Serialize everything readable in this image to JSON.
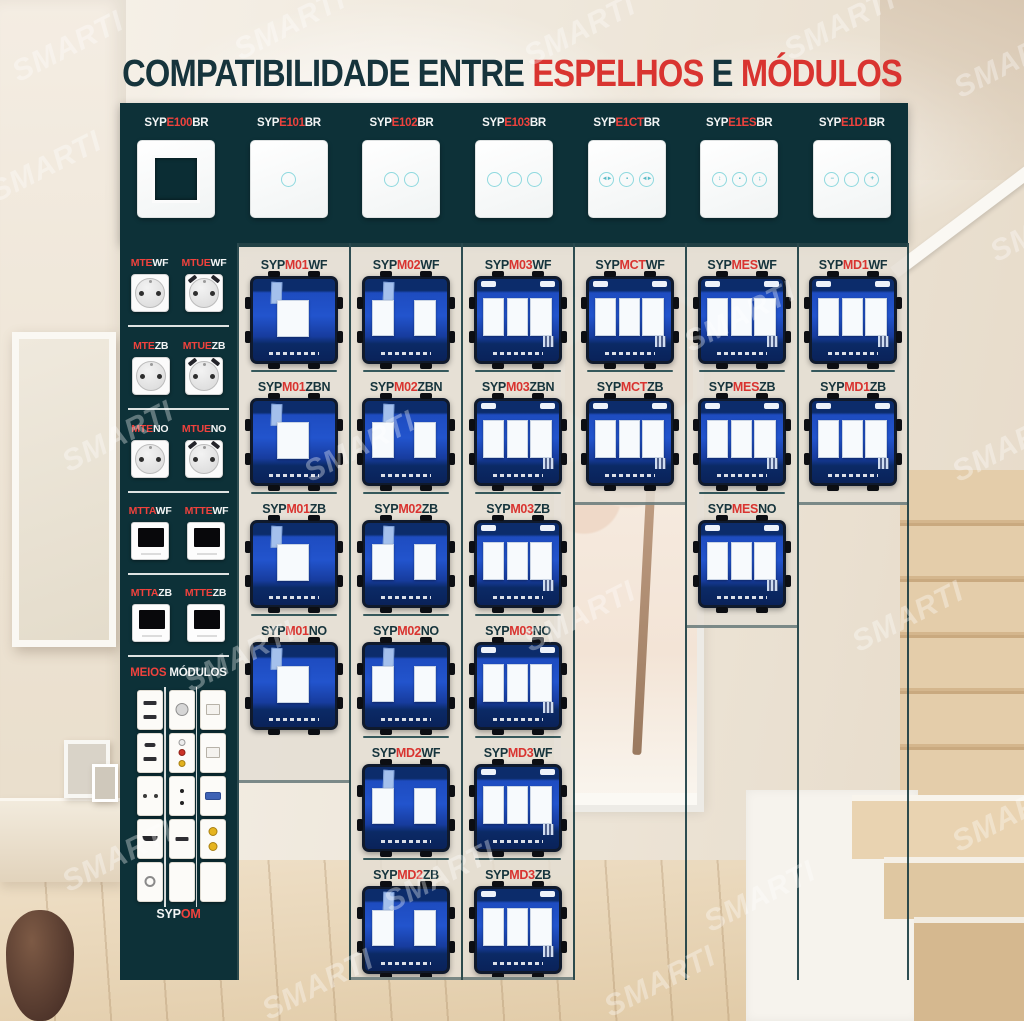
{
  "title": {
    "part1": "COMPATIBILIDADE ENTRE ",
    "part2": "ESPELHOS",
    "part3": " E ",
    "part4": "MÓDULOS"
  },
  "watermark": "SMARTI",
  "colors": {
    "teal_dark": "#0d3138",
    "red": "#d93430",
    "red_bright": "#ef423d",
    "text_dark": "#16343c",
    "module_blue": "#2254cd",
    "module_navy": "#0c2c6b",
    "circle_cyan": "#8fd9df",
    "column_fill": "rgba(228,222,211,0.85)"
  },
  "header_plates": {
    "prefix": "SYP",
    "suffix": "BR",
    "plates": [
      {
        "code": "E100",
        "type": "frame",
        "icons": []
      },
      {
        "code": "E101",
        "type": "touch",
        "icons": [
          ""
        ]
      },
      {
        "code": "E102",
        "type": "touch",
        "icons": [
          "",
          ""
        ]
      },
      {
        "code": "E103",
        "type": "touch",
        "icons": [
          "",
          "",
          ""
        ]
      },
      {
        "code": "E1CT",
        "type": "curtain",
        "icons": [
          "◄►",
          "▪",
          "◄►"
        ]
      },
      {
        "code": "E1ES",
        "type": "shutter",
        "icons": [
          "↕",
          "▪",
          "↨"
        ]
      },
      {
        "code": "E1D1",
        "type": "dimmer",
        "icons": [
          "−",
          "",
          "+"
        ]
      }
    ]
  },
  "left_panel": {
    "socket_rows": [
      {
        "left": {
          "code": "MTE",
          "suffix": "WF",
          "kind": "socket"
        },
        "right": {
          "code": "MTUE",
          "suffix": "WF",
          "kind": "socket-usb"
        }
      },
      {
        "left": {
          "code": "MTE",
          "suffix": "ZB",
          "kind": "socket"
        },
        "right": {
          "code": "MTUE",
          "suffix": "ZB",
          "kind": "socket-usb"
        }
      },
      {
        "left": {
          "code": "MTE",
          "suffix": "NO",
          "kind": "socket"
        },
        "right": {
          "code": "MTUE",
          "suffix": "NO",
          "kind": "socket-usb"
        }
      },
      {
        "left": {
          "code": "MTTA",
          "suffix": "WF",
          "kind": "thermostat"
        },
        "right": {
          "code": "MTTE",
          "suffix": "WF",
          "kind": "thermostat"
        }
      },
      {
        "left": {
          "code": "MTTA",
          "suffix": "ZB",
          "kind": "thermostat"
        },
        "right": {
          "code": "MTTE",
          "suffix": "ZB",
          "kind": "thermostat"
        }
      }
    ],
    "meios_title": {
      "part1": "MEIOS ",
      "part2": "MÓDULOS"
    },
    "meios_grid": [
      [
        "usb-double",
        "usb-c-a",
        "socket-2pin",
        "hdmi",
        "coax-round"
      ],
      [
        "tv-aerial",
        "rca-triple",
        "speaker-terminals",
        "usb-single",
        "blank"
      ],
      [
        "rj45",
        "rj45",
        "vga",
        "f-connector-double",
        "blank"
      ]
    ],
    "footer": {
      "prefix": "SYP",
      "code": "OM"
    }
  },
  "module_prefix": "SYP",
  "module_columns": [
    {
      "gangs": 1,
      "modules": [
        {
          "code": "M01",
          "suffix": "WF"
        },
        {
          "code": "M01",
          "suffix": "ZBN"
        },
        {
          "code": "M01",
          "suffix": "ZB"
        },
        {
          "code": "M01",
          "suffix": "NO"
        }
      ]
    },
    {
      "gangs": 2,
      "modules": [
        {
          "code": "M02",
          "suffix": "WF"
        },
        {
          "code": "M02",
          "suffix": "ZBN"
        },
        {
          "code": "M02",
          "suffix": "ZB"
        },
        {
          "code": "M02",
          "suffix": "NO"
        },
        {
          "code": "MD2",
          "suffix": "WF"
        },
        {
          "code": "MD2",
          "suffix": "ZB"
        }
      ]
    },
    {
      "gangs": 3,
      "modules": [
        {
          "code": "M03",
          "suffix": "WF"
        },
        {
          "code": "M03",
          "suffix": "ZBN"
        },
        {
          "code": "M03",
          "suffix": "ZB"
        },
        {
          "code": "M03",
          "suffix": "NO"
        },
        {
          "code": "MD3",
          "suffix": "WF"
        },
        {
          "code": "MD3",
          "suffix": "ZB"
        }
      ]
    },
    {
      "gangs": 3,
      "modules": [
        {
          "code": "MCT",
          "suffix": "WF"
        },
        {
          "code": "MCT",
          "suffix": "ZB"
        }
      ]
    },
    {
      "gangs": 3,
      "modules": [
        {
          "code": "MES",
          "suffix": "WF"
        },
        {
          "code": "MES",
          "suffix": "ZB"
        },
        {
          "code": "MES",
          "suffix": "NO"
        }
      ]
    },
    {
      "gangs": 3,
      "modules": [
        {
          "code": "MD1",
          "suffix": "WF"
        },
        {
          "code": "MD1",
          "suffix": "ZB"
        }
      ]
    }
  ]
}
